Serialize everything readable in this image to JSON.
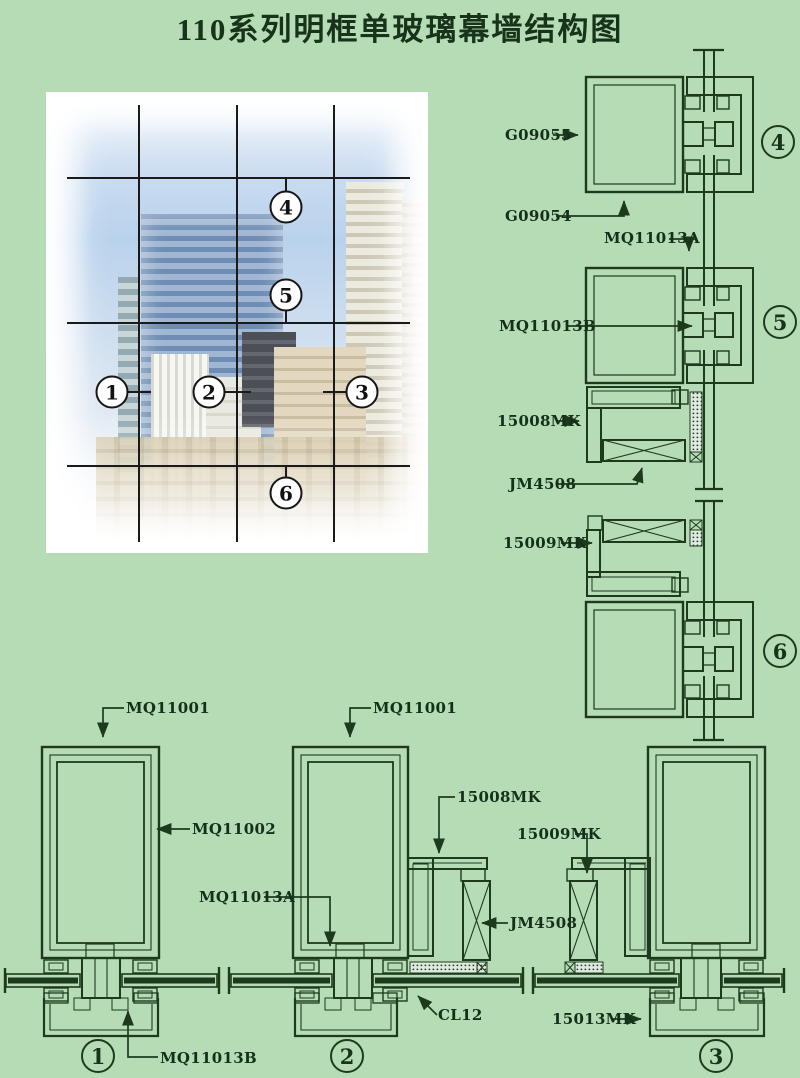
{
  "title": "110系列明框单玻璃幕墙结构图",
  "colors": {
    "background": "#b6dcb6",
    "line": "#1d3a1d",
    "text": "#14301a",
    "grid": "#1a1a1a"
  },
  "parts": {
    "g09055": "G09055",
    "g09054": "G09054",
    "mq11001": "MQ11001",
    "mq11002": "MQ11002",
    "mq11013a": "MQ11013A",
    "mq11013b": "MQ11013B",
    "mk15008": "15008MK",
    "mk15009": "15009MK",
    "mk15013": "15013MK",
    "jm4508": "JM4508",
    "cl12": "CL12"
  },
  "markers": {
    "s1": "1",
    "s2": "2",
    "s3": "3",
    "s4": "4",
    "s5": "5",
    "s6": "6"
  }
}
